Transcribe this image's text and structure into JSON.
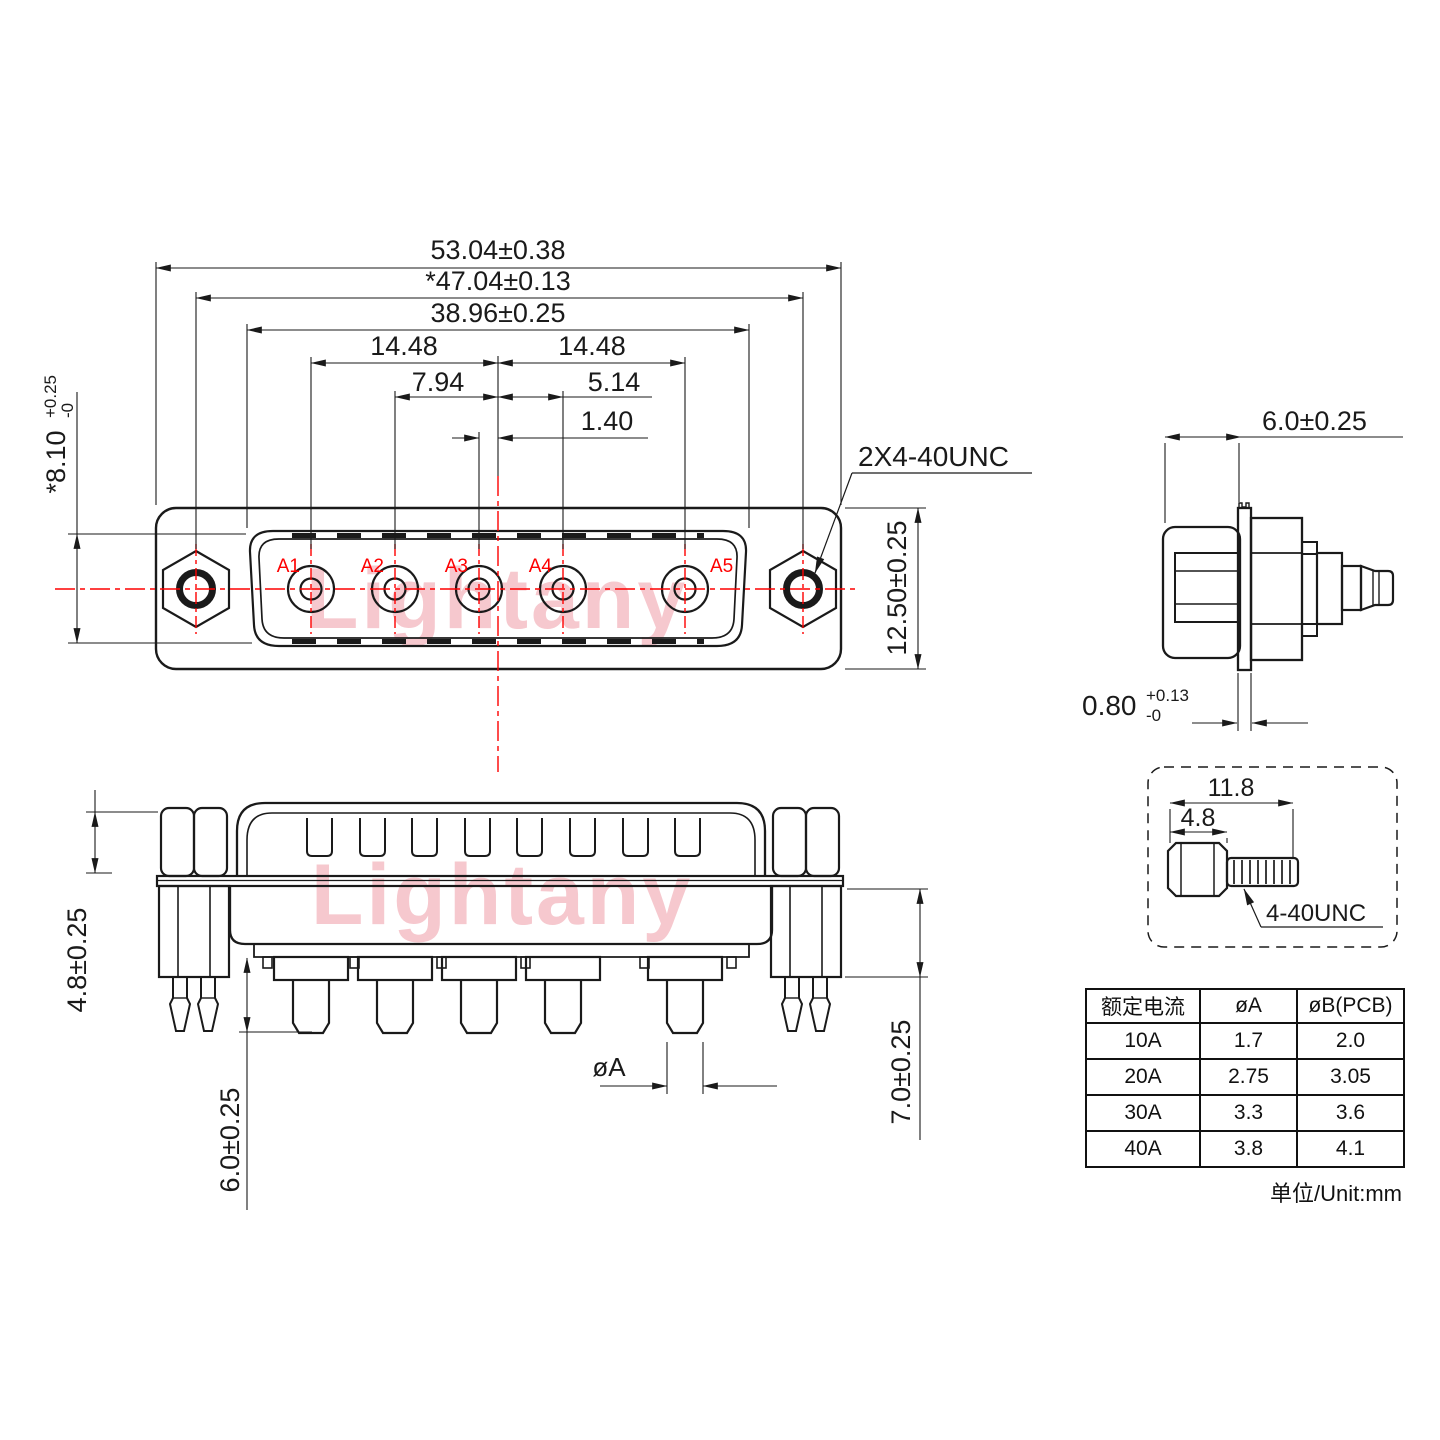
{
  "watermark": {
    "text": "Lightany",
    "color": "#f6c8ce"
  },
  "colors": {
    "line": "#1a1a1a",
    "accent_red": "#fe0000"
  },
  "front_view": {
    "pin_labels": [
      "A1",
      "A2",
      "A3",
      "A4",
      "A5"
    ],
    "dims": {
      "outer_width": "53.04±0.38",
      "mount_hole_span": "*47.04±0.13",
      "insert_width": "38.96±0.25",
      "pitch_left": "14.48",
      "pitch_right": "14.48",
      "pitch_a2": "7.94",
      "pitch_a4": "5.14",
      "pitch_a3": "1.40",
      "insert_height": "*8.10",
      "insert_height_tol_plus": "+0.25",
      "insert_height_tol_minus": "-0",
      "flange_height": "12.50±0.25",
      "mount_thread_callout": "2X4-40UNC"
    }
  },
  "side_view": {
    "dims": {
      "depth": "6.0±0.25",
      "flange_thickness": "0.80",
      "flange_thickness_tol_plus": "+0.13",
      "flange_thickness_tol_minus": "-0"
    }
  },
  "screw_detail": {
    "dims": {
      "overall_length": "11.8",
      "head_length": "4.8"
    },
    "thread_callout": "4-40UNC"
  },
  "bottom_view": {
    "dims": {
      "standoff_height": "4.8±0.25",
      "pin_length": "6.0±0.25",
      "boardlock_length": "7.0±0.25",
      "pin_diameter": "øA"
    }
  },
  "spec_table": {
    "headers": [
      "额定电流",
      "øA",
      "øB(PCB)"
    ],
    "rows": [
      [
        "10A",
        "1.7",
        "2.0"
      ],
      [
        "20A",
        "2.75",
        "3.05"
      ],
      [
        "30A",
        "3.3",
        "3.6"
      ],
      [
        "40A",
        "3.8",
        "4.1"
      ]
    ],
    "unit_note": "单位/Unit:mm"
  }
}
